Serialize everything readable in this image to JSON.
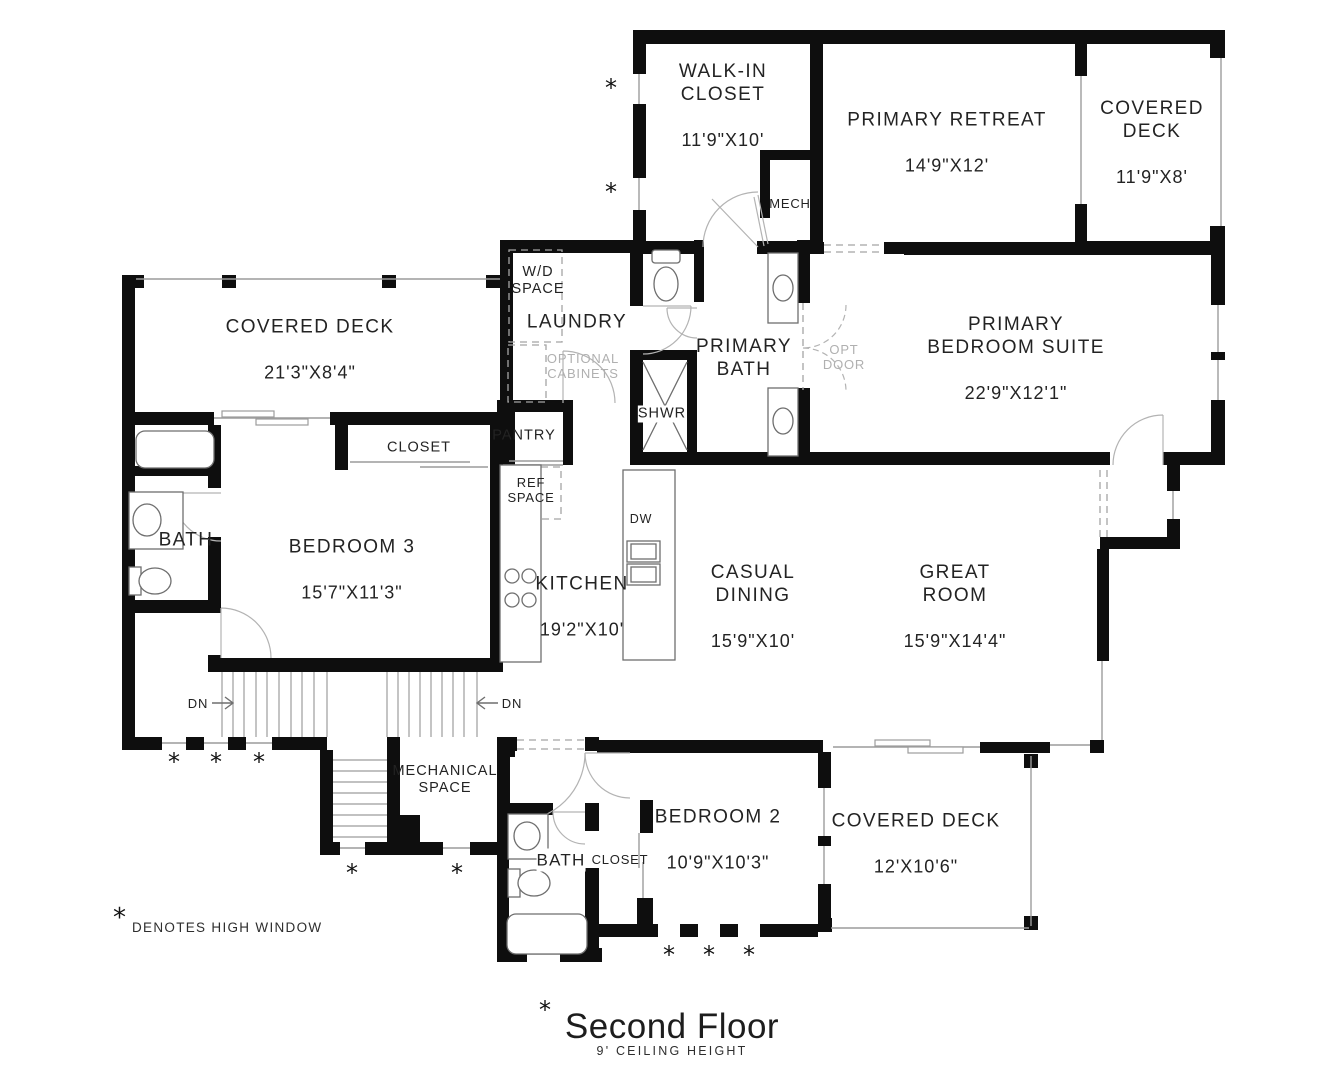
{
  "title": {
    "main": "Second Floor",
    "sub": "9' CEILING HEIGHT"
  },
  "legend": {
    "symbol": "*",
    "text": "DENOTES HIGH WINDOW"
  },
  "labels": {
    "dn": "DN"
  },
  "rooms": {
    "walk_in_closet": {
      "name": "WALK-IN\nCLOSET",
      "dims": "11'9\"X10'"
    },
    "primary_retreat": {
      "name": "PRIMARY RETREAT",
      "dims": "14'9\"X12'"
    },
    "covered_deck_ne": {
      "name": "COVERED\nDECK",
      "dims": "11'9\"X8'"
    },
    "mech": {
      "name": "MECH"
    },
    "wd_space": {
      "name": "W/D\nSPACE"
    },
    "laundry": {
      "name": "LAUNDRY"
    },
    "optional_cabinets": {
      "name": "OPTIONAL\nCABINETS"
    },
    "primary_bath": {
      "name": "PRIMARY\nBATH"
    },
    "opt_door": {
      "name": "OPT\nDOOR"
    },
    "primary_bedroom_suite": {
      "name": "PRIMARY\nBEDROOM SUITE",
      "dims": "22'9\"X12'1\""
    },
    "covered_deck_west": {
      "name": "COVERED DECK",
      "dims": "21'3\"X8'4\""
    },
    "closet_bedroom3": {
      "name": "CLOSET"
    },
    "pantry": {
      "name": "PANTRY"
    },
    "ref_space": {
      "name": "REF\nSPACE"
    },
    "shower": {
      "name": "SHWR"
    },
    "bath_west": {
      "name": "BATH"
    },
    "bedroom3": {
      "name": "BEDROOM 3",
      "dims": "15'7\"X11'3\""
    },
    "kitchen": {
      "name": "KITCHEN",
      "dims": "19'2\"X10'"
    },
    "dishwasher": {
      "name": "DW"
    },
    "casual_dining": {
      "name": "CASUAL\nDINING",
      "dims": "15'9\"X10'"
    },
    "great_room": {
      "name": "GREAT\nROOM",
      "dims": "15'9\"X14'4\""
    },
    "mechanical_space": {
      "name": "MECHANICAL\nSPACE"
    },
    "bath_south": {
      "name": "BATH"
    },
    "closet_bedroom2": {
      "name": "CLOSET"
    },
    "bedroom2": {
      "name": "BEDROOM 2",
      "dims": "10'9\"X10'3\""
    },
    "covered_deck_se": {
      "name": "COVERED DECK",
      "dims": "12'X10'6\""
    }
  }
}
